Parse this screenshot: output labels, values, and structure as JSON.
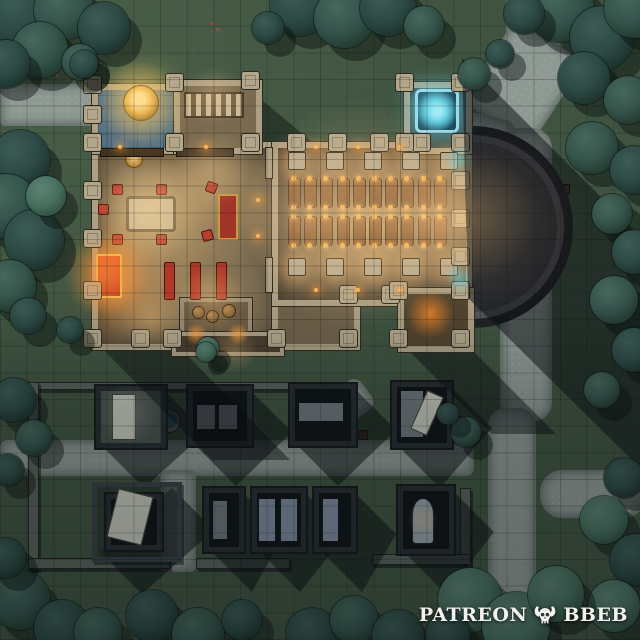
{
  "watermark": {
    "brand": "PATREON",
    "suffix": "BBEB",
    "icon": "horned-skull-icon"
  },
  "palette": {
    "grass": "#3f5340",
    "path": "#8e9993",
    "stone_wall": "#ac9f84",
    "wood_floor": "#77684f",
    "blue_tile": "#4e6e88",
    "tree_dark": "#2d4a45",
    "tree_light": "#5d8273",
    "shadow": "rgba(8,12,16,0.5)",
    "glow_warm": "#ffd79a",
    "glow_orange": "#ff8c28",
    "glow_cyan": "#7fe2f0",
    "accent_red": "#b8402e",
    "accent_gold": "#f0b050"
  },
  "grid": {
    "cells": 24,
    "line": "rgba(12,18,14,0.22)"
  },
  "scene": {
    "paths": [
      [
        0,
        84,
        100,
        38,
        0,
        6
      ],
      [
        506,
        0,
        52,
        54,
        0,
        2
      ],
      [
        482,
        32,
        78,
        96,
        33,
        18
      ],
      [
        462,
        116,
        46,
        38,
        14,
        10
      ],
      [
        500,
        128,
        48,
        290,
        0,
        20
      ],
      [
        488,
        408,
        44,
        232,
        0,
        18
      ],
      [
        540,
        470,
        102,
        44,
        0,
        22
      ],
      [
        0,
        440,
        470,
        32,
        0,
        8
      ],
      [
        298,
        394,
        72,
        32,
        -36,
        10
      ],
      [
        160,
        470,
        32,
        98,
        0,
        6
      ]
    ],
    "gwalls": [
      [
        28,
        382,
        270,
        6
      ],
      [
        28,
        382,
        9,
        186
      ],
      [
        28,
        558,
        140,
        9
      ],
      [
        196,
        558,
        92,
        9
      ],
      [
        460,
        488,
        9,
        74
      ],
      [
        372,
        554,
        97,
        9
      ]
    ],
    "well": {
      "x": 168,
      "y": 420,
      "r": 11
    },
    "benches": [
      [
        346,
        430,
        20,
        8
      ],
      [
        552,
        184,
        16,
        8
      ],
      [
        552,
        220,
        16,
        8
      ]
    ],
    "flowers": [
      [
        62,
        62
      ],
      [
        70,
        70
      ],
      [
        56,
        74
      ],
      [
        78,
        58
      ],
      [
        210,
        22
      ],
      [
        216,
        28
      ],
      [
        66,
        78
      ],
      [
        74,
        64
      ]
    ],
    "mausoleums": [
      {
        "x": 94,
        "y": 384,
        "w": 70,
        "h": 62,
        "lit": true,
        "slabs": [
          {
            "x": 112,
            "y": 394,
            "w": 22,
            "h": 44,
            "c": "slabL"
          }
        ]
      },
      {
        "x": 186,
        "y": 384,
        "w": 64,
        "h": 60,
        "slabs": [
          {
            "x": 196,
            "y": 404,
            "w": 18,
            "h": 24,
            "c": "slabG"
          },
          {
            "x": 218,
            "y": 404,
            "w": 18,
            "h": 24,
            "c": "slabG"
          }
        ]
      },
      {
        "x": 288,
        "y": 382,
        "w": 66,
        "h": 62,
        "slabs": [
          {
            "x": 298,
            "y": 402,
            "w": 44,
            "h": 18,
            "c": "slabG"
          }
        ]
      },
      {
        "x": 390,
        "y": 380,
        "w": 60,
        "h": 66,
        "slabs": [
          {
            "x": 400,
            "y": 390,
            "w": 22,
            "h": 46,
            "c": "slabG"
          },
          {
            "x": 418,
            "y": 392,
            "w": 16,
            "h": 40,
            "c": "slabL",
            "rot": 24
          }
        ]
      },
      {
        "x": 92,
        "y": 482,
        "w": 80,
        "h": 70,
        "yard": true,
        "slabs": [
          {
            "x": 112,
            "y": 492,
            "w": 34,
            "h": 48,
            "c": "slabL",
            "rot": 14
          }
        ]
      },
      {
        "x": 202,
        "y": 486,
        "w": 40,
        "h": 64,
        "slabs": [
          {
            "x": 212,
            "y": 500,
            "w": 14,
            "h": 38,
            "c": "slabG"
          }
        ]
      },
      {
        "x": 250,
        "y": 486,
        "w": 54,
        "h": 64,
        "slabs": [
          {
            "x": 258,
            "y": 498,
            "w": 16,
            "h": 42,
            "c": "slabB"
          },
          {
            "x": 280,
            "y": 498,
            "w": 16,
            "h": 42,
            "c": "slabB"
          }
        ]
      },
      {
        "x": 312,
        "y": 486,
        "w": 42,
        "h": 64,
        "slabs": [
          {
            "x": 322,
            "y": 498,
            "w": 15,
            "h": 42,
            "c": "slabB"
          }
        ]
      },
      {
        "x": 396,
        "y": 484,
        "w": 56,
        "h": 68,
        "slabs": [
          {
            "x": 412,
            "y": 498,
            "w": 20,
            "h": 44,
            "c": "slabA"
          }
        ]
      }
    ],
    "shadows": [
      {
        "pts": [
          [
            462,
            58
          ],
          [
            640,
            236
          ],
          [
            640,
            468
          ],
          [
            468,
            298
          ]
        ],
        "c": "rgba(8,12,16,0.5)"
      },
      {
        "pts": [
          [
            92,
            338
          ],
          [
            170,
            338
          ],
          [
            290,
            460
          ],
          [
            212,
            460
          ]
        ],
        "c": "rgba(8,12,16,0.45)"
      },
      {
        "pts": [
          [
            400,
            342
          ],
          [
            464,
            342
          ],
          [
            556,
            434
          ],
          [
            492,
            434
          ]
        ],
        "c": "rgba(8,12,16,0.45)"
      },
      {
        "pts": [
          [
            148,
            102
          ],
          [
            238,
            144
          ],
          [
            148,
            144
          ]
        ],
        "c": "rgba(14,20,38,0.5)"
      },
      {
        "pts": [
          [
            250,
            90
          ],
          [
            312,
            142
          ],
          [
            250,
            142
          ]
        ],
        "c": "rgba(10,16,14,0.45)"
      }
    ],
    "church": {
      "parts": [
        {
          "c": "apse",
          "cx": 463,
          "cy": 218,
          "r": 92
        },
        {
          "c": "hall",
          "x": 92,
          "y": 142,
          "w": 180,
          "h": 196
        },
        {
          "c": "aisle",
          "x": 272,
          "y": 280,
          "w": 76,
          "h": 58
        },
        {
          "c": "nave",
          "x": 272,
          "y": 142,
          "w": 188,
          "h": 152
        },
        {
          "c": "plaza",
          "x": 92,
          "y": 84,
          "w": 82,
          "h": 58
        },
        {
          "c": "annex",
          "x": 174,
          "y": 80,
          "w": 76,
          "h": 62
        },
        {
          "c": "neroom",
          "x": 404,
          "y": 82,
          "w": 56,
          "h": 60
        },
        {
          "c": "sacr",
          "x": 180,
          "y": 298,
          "w": 64,
          "h": 34
        },
        {
          "c": "porch",
          "x": 172,
          "y": 332,
          "w": 104,
          "h": 16
        },
        {
          "c": "stower",
          "x": 398,
          "y": 288,
          "w": 64,
          "h": 52
        }
      ],
      "wallstubs": [
        [
          266,
          148,
          6,
          30
        ],
        [
          266,
          258,
          6,
          34
        ]
      ],
      "towers": [
        [
          92,
          84
        ],
        [
          92,
          114
        ],
        [
          92,
          142
        ],
        [
          92,
          190
        ],
        [
          92,
          238
        ],
        [
          92,
          290
        ],
        [
          92,
          338
        ],
        [
          140,
          338
        ],
        [
          172,
          338
        ],
        [
          276,
          338
        ],
        [
          348,
          338
        ],
        [
          348,
          294
        ],
        [
          390,
          294
        ],
        [
          174,
          82
        ],
        [
          250,
          80
        ],
        [
          250,
          142
        ],
        [
          174,
          142
        ],
        [
          296,
          142
        ],
        [
          337,
          142
        ],
        [
          379,
          142
        ],
        [
          421,
          142
        ],
        [
          460,
          142
        ],
        [
          404,
          82
        ],
        [
          460,
          82
        ],
        [
          404,
          142
        ],
        [
          460,
          180
        ],
        [
          460,
          218
        ],
        [
          460,
          256
        ],
        [
          398,
          290
        ],
        [
          460,
          290
        ],
        [
          398,
          338
        ],
        [
          460,
          338
        ]
      ],
      "columns": {
        "xs": [
          296,
          334,
          372,
          410,
          448
        ],
        "rows": [
          160,
          266
        ],
        "s": 16
      },
      "pews": {
        "rows": [
          178,
          216
        ],
        "x0": 288,
        "dx": 16.2,
        "n": 10,
        "w": 11,
        "h": 28
      },
      "furniture": [
        {
          "c": "tableB",
          "x": 126,
          "y": 196,
          "w": 44,
          "h": 30
        },
        {
          "c": "chair",
          "x": 112,
          "y": 184,
          "w": 9,
          "h": 9
        },
        {
          "c": "chair",
          "x": 156,
          "y": 184,
          "w": 9,
          "h": 9
        },
        {
          "c": "chair",
          "x": 112,
          "y": 234,
          "w": 9,
          "h": 9
        },
        {
          "c": "chair",
          "x": 156,
          "y": 234,
          "w": 9,
          "h": 9
        },
        {
          "c": "chair",
          "x": 206,
          "y": 182,
          "w": 9,
          "h": 9,
          "rot": 20
        },
        {
          "c": "chair",
          "x": 202,
          "y": 230,
          "w": 9,
          "h": 9,
          "rot": -15
        },
        {
          "c": "chair",
          "x": 98,
          "y": 204,
          "w": 9,
          "h": 9
        },
        {
          "c": "benchR",
          "x": 164,
          "y": 262,
          "w": 9,
          "h": 36
        },
        {
          "c": "benchR",
          "x": 190,
          "y": 262,
          "w": 9,
          "h": 36
        },
        {
          "c": "benchR",
          "x": 216,
          "y": 262,
          "w": 9,
          "h": 36
        },
        {
          "c": "altar",
          "x": 96,
          "y": 254,
          "w": 22,
          "h": 40
        },
        {
          "c": "carpet",
          "x": 218,
          "y": 194,
          "w": 16,
          "h": 42
        },
        {
          "c": "medal",
          "x": 125,
          "y": 150,
          "w": 16,
          "h": 16
        },
        {
          "c": "benchD",
          "x": 100,
          "y": 148,
          "w": 62,
          "h": 7
        },
        {
          "c": "benchD",
          "x": 176,
          "y": 148,
          "w": 56,
          "h": 7
        },
        {
          "c": "stairs",
          "x": 184,
          "y": 92,
          "w": 56,
          "h": 22
        },
        {
          "c": "barrel",
          "x": 192,
          "y": 306,
          "w": 11,
          "h": 11
        },
        {
          "c": "barrel",
          "x": 206,
          "y": 310,
          "w": 11,
          "h": 11
        },
        {
          "c": "barrel",
          "x": 222,
          "y": 304,
          "w": 12,
          "h": 12
        },
        {
          "c": "portal",
          "x": 415,
          "y": 89,
          "w": 38,
          "h": 38
        },
        {
          "c": "goldtree",
          "x": 123,
          "y": 85,
          "w": 34,
          "h": 34
        }
      ],
      "lamps": [
        [
          316,
          147
        ],
        [
          358,
          147
        ],
        [
          400,
          147
        ],
        [
          316,
          290
        ],
        [
          358,
          290
        ],
        [
          400,
          290
        ],
        [
          120,
          147
        ],
        [
          206,
          147
        ],
        [
          258,
          200
        ],
        [
          258,
          236
        ]
      ],
      "glows": [
        [
          150,
          210,
          55,
          "rgba(255,215,150,0.5)"
        ],
        [
          212,
          168,
          40,
          "rgba(255,210,145,0.33)"
        ],
        [
          105,
          274,
          42,
          "rgba(255,150,60,0.55)"
        ],
        [
          212,
          300,
          34,
          "rgba(255,200,120,0.35)"
        ],
        [
          150,
          318,
          30,
          "rgba(255,200,120,0.3)"
        ],
        [
          360,
          214,
          115,
          "rgba(255,210,150,0.38)"
        ],
        [
          305,
          214,
          70,
          "rgba(255,210,150,0.3)"
        ],
        [
          428,
          214,
          70,
          "rgba(255,210,150,0.3)"
        ],
        [
          472,
          216,
          66,
          "rgba(255,205,138,0.5)"
        ],
        [
          490,
          218,
          95,
          "rgba(255,200,130,0.22)"
        ],
        [
          430,
          314,
          24,
          "rgba(255,140,40,0.8)"
        ],
        [
          433,
          108,
          26,
          "rgba(127,226,240,0.6)"
        ],
        [
          460,
          160,
          15,
          "rgba(102,216,232,0.55)"
        ],
        [
          460,
          278,
          15,
          "rgba(102,216,232,0.55)"
        ],
        [
          140,
          102,
          42,
          "rgba(255,207,110,0.5)"
        ],
        [
          196,
          334,
          11,
          "rgba(255,160,60,0.8)"
        ],
        [
          238,
          334,
          11,
          "rgba(255,160,60,0.8)"
        ],
        [
          128,
          414,
          30,
          "rgba(205,215,205,0.28)"
        ],
        [
          422,
          520,
          16,
          "rgba(255,190,110,0.25)"
        ],
        [
          234,
          350,
          24,
          "rgba(255,200,130,0.3)"
        ],
        [
          214,
          96,
          30,
          "rgba(255,210,150,0.3)"
        ]
      ]
    },
    "trees": [
      [
        20,
        16,
        34,
        1
      ],
      [
        64,
        10,
        30,
        0
      ],
      [
        104,
        28,
        26,
        1
      ],
      [
        40,
        50,
        28,
        0
      ],
      [
        6,
        64,
        24,
        1
      ],
      [
        80,
        62,
        18,
        0
      ],
      [
        300,
        6,
        30,
        1
      ],
      [
        344,
        18,
        30,
        0
      ],
      [
        388,
        8,
        28,
        1
      ],
      [
        424,
        26,
        20,
        0
      ],
      [
        268,
        28,
        16,
        1
      ],
      [
        560,
        8,
        34,
        0
      ],
      [
        602,
        38,
        32,
        1
      ],
      [
        634,
        8,
        30,
        0
      ],
      [
        584,
        78,
        26,
        1
      ],
      [
        628,
        100,
        24,
        0
      ],
      [
        524,
        14,
        20,
        1
      ],
      [
        592,
        148,
        26,
        0
      ],
      [
        634,
        170,
        24,
        1
      ],
      [
        612,
        214,
        20,
        0
      ],
      [
        634,
        252,
        22,
        1
      ],
      [
        614,
        300,
        24,
        0
      ],
      [
        634,
        350,
        22,
        1
      ],
      [
        602,
        390,
        18,
        0
      ],
      [
        624,
        478,
        20,
        1
      ],
      [
        604,
        520,
        24,
        2
      ],
      [
        636,
        560,
        26,
        1
      ],
      [
        614,
        606,
        26,
        2
      ],
      [
        20,
        160,
        30,
        1
      ],
      [
        6,
        206,
        32,
        0
      ],
      [
        34,
        240,
        30,
        1
      ],
      [
        10,
        286,
        26,
        0
      ],
      [
        46,
        196,
        20,
        2
      ],
      [
        28,
        316,
        18,
        1
      ],
      [
        14,
        400,
        22,
        1
      ],
      [
        34,
        438,
        18,
        0
      ],
      [
        8,
        470,
        16,
        1
      ],
      [
        20,
        600,
        30,
        0
      ],
      [
        62,
        628,
        28,
        1
      ],
      [
        6,
        558,
        20,
        1
      ],
      [
        98,
        632,
        24,
        0
      ],
      [
        152,
        616,
        26,
        1
      ],
      [
        198,
        634,
        26,
        0
      ],
      [
        242,
        620,
        20,
        1
      ],
      [
        312,
        634,
        26,
        1
      ],
      [
        354,
        620,
        24,
        0
      ],
      [
        398,
        636,
        26,
        1
      ],
      [
        470,
        600,
        32,
        2
      ],
      [
        516,
        626,
        34,
        2
      ],
      [
        556,
        594,
        28,
        2
      ],
      [
        448,
        634,
        22,
        1
      ],
      [
        208,
        348,
        11,
        2
      ],
      [
        466,
        432,
        15,
        0
      ],
      [
        448,
        414,
        11,
        1
      ],
      [
        84,
        64,
        14,
        1
      ],
      [
        474,
        74,
        16,
        0
      ],
      [
        500,
        54,
        14,
        1
      ],
      [
        206,
        352,
        10,
        2
      ],
      [
        70,
        330,
        13,
        1
      ]
    ]
  }
}
